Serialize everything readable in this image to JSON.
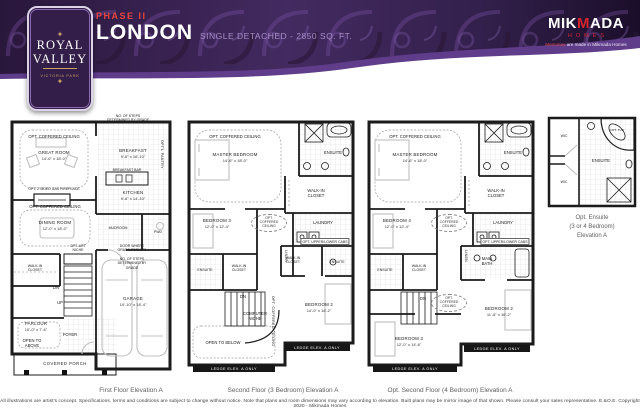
{
  "header": {
    "phase": "PHASE II",
    "model": "LONDON",
    "subtitle": "SINGLE DETACHED - 2850 SQ. FT.",
    "logo": {
      "line1": "ROYAL",
      "line2": "VALLEY",
      "line3": "VICTORIA PARK"
    },
    "builder": {
      "mik": "MIK",
      "m": "M",
      "ada": "ADA",
      "homes": "HOMES",
      "tag_red": "Memories",
      "tag_rest": " are made in Mikmada Homes"
    }
  },
  "plan1": {
    "caption": "First Floor Elevation A",
    "labels": {
      "steps_note": "NO. OF STEPS DETERMINED BY GRADE",
      "opt_ceiling_great": "OPT. COFFERED CEILING",
      "great_room": "GREAT ROOM",
      "great_room_dims": "14'-6\" x 18'-0\"",
      "fireplace": "OPT. 2 SIDED GAS FIREPLACE",
      "opt_ceiling_dining": "OPT. COFFERED CEILING",
      "dining": "DINING ROOM",
      "dining_dims": "12'-0\" x 18'-0\"",
      "breakfast": "BREAKFAST",
      "breakfast_dims": "9'-6\" x 16'-10\"",
      "breakfast_bar": "BREAKFAST BAR",
      "kitchen": "KITCHEN",
      "kitchen_dims": "9'-6\" x 14'-10\"",
      "pantry": "OPT'L PANTRY",
      "mudroom": "MUDROOM",
      "pwd": "PWD",
      "door_note": "DOOR WHERE GRADE PERMITS",
      "steps_note2": "NO. OF STEPS DETERMINED BY GRADE",
      "wic": "WALK-IN CLOSET",
      "art_niche": "OPT. ART NICHE",
      "dn": "DN",
      "up": "UP",
      "parlour": "PARLOUR",
      "parlour_dims": "10'-0\" x 7'-6\"",
      "open_above": "OPEN TO ABOVE",
      "foyer": "FOYER",
      "garage": "GARAGE",
      "garage_dims": "19'-10\" x 18'-4\"",
      "porch": "COVERED PORCH"
    }
  },
  "plan2": {
    "caption": "Second Floor (3 Bedroom) Elevation A",
    "labels": {
      "opt_ceiling": "OPT. COFFERED CEILING",
      "master": "MASTER BEDROOM",
      "master_dims": "14'-6\" x 18'-0\"",
      "ensuite": "ENSUITE",
      "wic_master": "WALK-IN CLOSET",
      "bedroom3": "BEDROOM 3",
      "bedroom3_dims": "12'-0\" x 12'-4\"",
      "opt_ceiling2": "OPT. COFFERED CEILING",
      "laundry": "LAUNDRY",
      "cabs": "OPT. UPPER/LOWER CABS",
      "linen": "LINEN",
      "ensuite_b3": "ENSUITE",
      "wic_b3": "WALK-IN CLOSET",
      "wic_b2": "WALK-IN CLOSET",
      "ensuite_b2": "ENSUITE",
      "dn": "DN",
      "computer_niche": "COMPUTER NICHE",
      "opt_ceiling_hall": "OPT. COFFERED CEILING",
      "bedroom2": "BEDROOM 2",
      "bedroom2_dims": "14'-0\" x 16'-2\"",
      "open_below": "OPEN TO BELOW",
      "ledge": "LEDGE ELEV. A ONLY"
    }
  },
  "plan3": {
    "caption": "Opt. Second Floor (4 Bedroom) Elevation A",
    "labels": {
      "opt_ceiling": "OPT. COFFERED CEILING",
      "master": "MASTER BEDROOM",
      "master_dims": "14'-6\" x 18'-0\"",
      "ensuite": "ENSUITE",
      "wic_master": "WALK-IN CLOSET",
      "bedroom4": "BEDROOM 4",
      "bedroom4_dims": "12'-0\" x 12'-4\"",
      "opt_ceiling2": "OPT. COFFERED CEILING",
      "laundry": "LAUNDRY",
      "cabs": "OPT. UPPER/LOWER CABS",
      "linen": "LINEN",
      "main_bath": "MAIN BATH",
      "ensuite_b3": "ENSUITE",
      "wic_b3": "WALK-IN CLOSET",
      "dn": "DN",
      "opt_ceiling_hall": "OPT. COFFERED CEILING",
      "bedroom2": "BEDROOM 2",
      "bedroom2_dims": "11'-8\" x 16'-2\"",
      "bedroom3": "BEDROOM 3",
      "bedroom3_dims": "12'-0\" x 14'-6\"",
      "ledge": "LEDGE ELEV. A ONLY"
    }
  },
  "ensuite_detail": {
    "wic1": "WIC",
    "wic2": "WIC",
    "ensuite": "ENSUITE",
    "tub": "OPT. TUB",
    "caption1": "Opt. Ensuite",
    "caption2": "(3 or 4 Bedroom)",
    "caption3": "Elevation A"
  },
  "footer": "All illustrations are artist's concept. Specifications, terms and conditions are subject to change without notice. Note that plans and room dimensions may vary according to elevation. Built plans may be mirror image of that shown. Please consult your sales representative. E.&O.E. Copyright 2020 - Mikmada Homes"
}
